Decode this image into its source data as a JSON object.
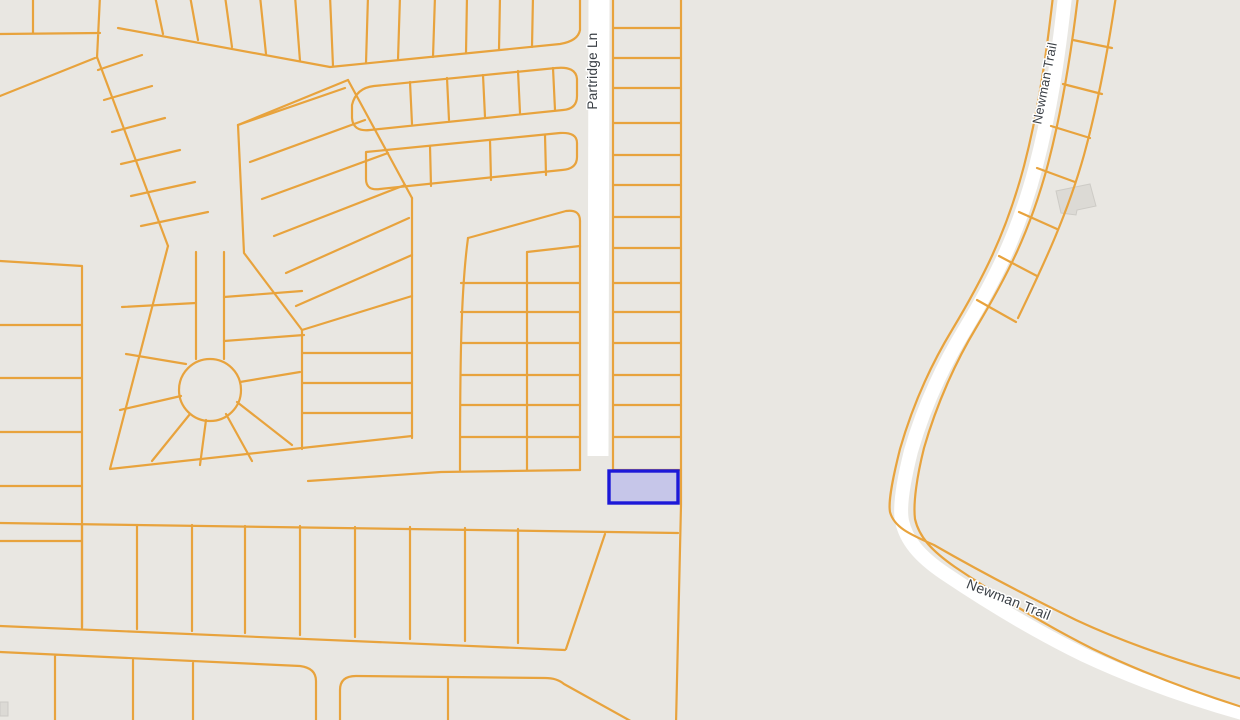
{
  "map": {
    "viewport": {
      "width": 1240,
      "height": 720
    },
    "background_color": "#e9e7e2",
    "parcel_line_color": "#e8a33d",
    "parcel_line_width": 2.2,
    "road_color": "#ffffff",
    "building_fill": "#dcdad5",
    "building_edge": "#cdcbc6",
    "label_color": "#3b4046",
    "highlight": {
      "name": "highlighted-parcel",
      "x": 609,
      "y": 471,
      "width": 69,
      "height": 32,
      "stroke": "#1c18d8",
      "stroke_width": 3.4,
      "fill": "#c6c6e9"
    },
    "labels": [
      {
        "name": "street-label-partridge-ln",
        "text": "Partridge Ln",
        "x": 597,
        "y": 71,
        "rotation": -90,
        "size": 13.5
      },
      {
        "name": "street-label-newman-trail-top",
        "text": "Newman Trail",
        "x": 1049,
        "y": 84,
        "rotation": -79,
        "size": 13
      },
      {
        "name": "street-label-newman-trail-bottom",
        "text": "Newman Trail",
        "x": 1007,
        "y": 604,
        "rotation": 21.5,
        "size": 14
      }
    ],
    "roads": [
      {
        "name": "road-partridge-ln",
        "width": 21,
        "d": "M599,-4 L598,456"
      },
      {
        "name": "road-newman-trail",
        "width": 14,
        "d": "M1065,-4 C1058,60 1050,112 1036,166 C1018,235 994,281 964,331 C944,364 924,406 911,451 C904,479 899,506 902,521 C906,540 919,556 944,573 C990,604 1039,633 1084,655 C1129,676 1181,696 1246,714"
      }
    ],
    "parcel_paths": [
      {
        "name": "partridge-column-left-edge",
        "d": "M613,-4 L613,471"
      },
      {
        "name": "partridge-column-right-edge",
        "d": "M681,-4 L681,505 L676,724"
      },
      {
        "name": "partridge-column-dividers",
        "d": "M613,28 L681,28 M613,58 L681,58 M613,88 L681,88 M613,123 L681,123 M613,155 L681,155 M613,185 L681,185 M613,217 L681,217 M613,248 L681,248 M613,283 L681,283 M613,312 L681,312 M613,343 L681,343 M613,375 L681,375 M613,405 L681,405 M613,437 L681,437 M613,470 L681,470"
      },
      {
        "name": "newman-boundary-outer",
        "d": "M1053,-4 C1046,58 1038,112 1024,166 C1006,234 982,280 952,330 C932,363 913,404 900,449 C893,477 888,501 890,512 C894,527 909,534 934,545 C981,572 1031,598 1076,620 C1121,641 1177,661 1242,679"
      },
      {
        "name": "newman-boundary-inner",
        "d": "M1078,-4 C1071,55 1062,110 1048,164 C1030,232 1006,278 976,328 C956,361 937,403 924,448 C917,476 913,503 915,519 C919,537 932,551 955,567 C1001,598 1049,627 1093,649 C1137,670 1188,690 1242,707"
      },
      {
        "name": "newman-strip-outer-edge",
        "d": "M1116,-4 C1108,50 1098,104 1084,155 C1068,212 1046,260 1018,318"
      },
      {
        "name": "newman-strip-dividers",
        "d": "M1073,40 L1112,48 M1063,84 L1102,94 M1051,126 L1090,138 M1037,168 L1075,182 M1019,212 L1057,229 M999,256 L1037,276 M977,300 L1016,322"
      },
      {
        "name": "topleft-mini-block",
        "d": "M33,-4 L33,33 M0,34 L100,33 M100,-4 L97,58 M0,96 L95,58"
      },
      {
        "name": "fan-block-left-edge",
        "d": "M97,57 L168,246"
      },
      {
        "name": "fan-block-rungs",
        "d": "M98,70 L142,55 M104,100 L152,86 M112,132 L165,118 M121,164 L180,150 M131,196 L195,182 M141,226 L208,212"
      },
      {
        "name": "top-band-bottom-edge",
        "d": "M118,28 L330,67 L560,44 Q578,41 580,30 L580,-4"
      },
      {
        "name": "top-band-dividers",
        "d": "M155,-4 L163,34 M190,-4 L198,40 M225,-4 L232,47 M260,-4 L266,54 M295,-4 L300,61 M330,-4 L333,66 M368,-4 L366,63 M400,-4 L398,60 M435,-4 L433,57 M467,-4 L466,53 M500,-4 L499,50 M533,-4 L532,47"
      },
      {
        "name": "block-b-outline",
        "d": "M352,105 Q356,88 374,86 L556,68 Q576,66 577,79 L577,96 Q577,109 563,110 L370,130 Q353,132 352,118 Z"
      },
      {
        "name": "block-b-dividers",
        "d": "M410,82 L412,124 M447,78 L449,120 M483,75 L485,117 M518,71 L520,113 M553,68 L555,110"
      },
      {
        "name": "block-c-outline",
        "d": "M366,152 L560,133 Q577,132 577,143 L577,157 Q577,169 562,170 L380,189 Q366,191 366,179 Z"
      },
      {
        "name": "block-c-dividers",
        "d": "M430,146 L431,186 M490,140 L491,180 M545,135 L546,175"
      },
      {
        "name": "wedge-lot-lines",
        "d": "M238,125 L345,88 M250,162 L365,120 M262,199 L388,153 M274,236 L405,185 M286,273 L409,218 M296,306 L412,255"
      },
      {
        "name": "wedge-left-edge",
        "d": "M238,125 L244,253 L302,330"
      },
      {
        "name": "wedge-top-edge",
        "d": "M238,125 L348,80"
      },
      {
        "name": "wedge-right-edge",
        "d": "M348,80 L412,198"
      },
      {
        "name": "mid-column-right-edge",
        "d": "M412,198 L412,438"
      },
      {
        "name": "mid-column-left-edge",
        "d": "M302,330 L302,449"
      },
      {
        "name": "mid-column-top-edge",
        "d": "M302,330 L412,296"
      },
      {
        "name": "mid-column-dividers",
        "d": "M302,353 L412,353 M302,383 L412,383 M302,413 L412,413"
      },
      {
        "name": "culdesac-block-outline",
        "d": "M168,246 L110,469 L302,448 L412,436"
      },
      {
        "name": "culdesac-stem-edges",
        "d": "M196,252 L196,359 M224,252 L224,359"
      },
      {
        "name": "culdesac-bulb",
        "d": "M241,390 A31,31 0 1 0 179,390 A31,31 0 1 0 241,390"
      },
      {
        "name": "culdesac-spokes",
        "d": "M186,364 L126,354 M181,396 L120,410 M190,414 L152,461 M206,420 L200,465 M226,414 L252,461 M237,402 L292,445 M240,382 L300,372"
      },
      {
        "name": "stem-side-lot-lines",
        "d": "M196,303 L122,307 M224,297 L302,291 M224,341 L304,335"
      },
      {
        "name": "d-block-top-edge",
        "d": "M468,238 L566,211 Q580,209 580,221"
      },
      {
        "name": "d-block-right-edge",
        "d": "M580,221 L580,470"
      },
      {
        "name": "d-block-left-edge",
        "d": "M468,238 C461,290 460,360 460,470"
      },
      {
        "name": "d-block-bottom-edge",
        "d": "M308,481 L441,472 L580,470"
      },
      {
        "name": "d-block-vertical-divider",
        "d": "M527,252 L527,470 M527,252 L580,246"
      },
      {
        "name": "d-block-dividers",
        "d": "M461,283 L580,283 M461,312 L580,312 M461,343 L580,343 M461,375 L580,375 M461,405 L580,405 M461,437 L580,437"
      },
      {
        "name": "left-strip-edges",
        "d": "M82,266 L82,628 M0,261 L82,266"
      },
      {
        "name": "left-strip-dividers",
        "d": "M0,325 L82,325 M0,378 L82,378 M0,432 L82,432 M0,486 L82,486 M0,541 L82,541"
      },
      {
        "name": "row1-top-boundary",
        "d": "M0,523 L678,533"
      },
      {
        "name": "row1-bottom-boundary",
        "d": "M0,626 L565,650"
      },
      {
        "name": "row1-dividers",
        "d": "M82,524 L82,627 M137,525 L137,629 M192,525 L192,631 M245,526 L245,633 M300,526 L300,635 M355,527 L355,637 M410,527 L410,639 M465,528 L465,641 M518,529 L518,643"
      },
      {
        "name": "row1-right-diagonal",
        "d": "M605,534 L566,649"
      },
      {
        "name": "bottom-left-block",
        "d": "M0,652 L300,666 Q316,668 316,681 L316,724 M55,655 L55,724 M133,660 L133,724 M193,663 L193,724"
      },
      {
        "name": "bottom-right-block",
        "d": "M340,724 L340,690 Q340,676 356,676 L545,678 Q557,678 564,684 L636,724 M448,677 L448,724"
      }
    ],
    "buildings": [
      {
        "name": "building-footprint-newman",
        "points": "1056,191 1090,184 1096,206 1077,210 1076,215 1061,213"
      },
      {
        "name": "building-footprint-bottom-left",
        "points": "0,702 8,702 8,716 0,716"
      }
    ]
  }
}
